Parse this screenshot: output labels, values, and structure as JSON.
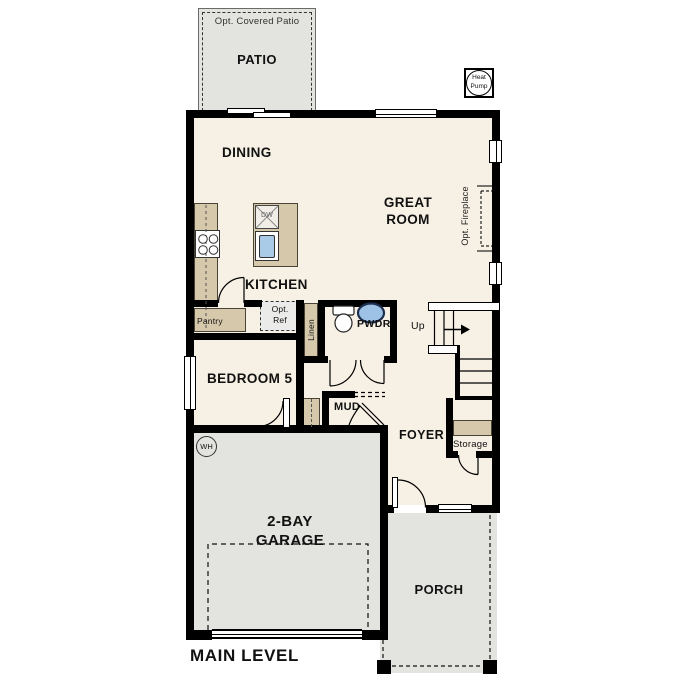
{
  "plan": {
    "level_title": "MAIN LEVEL",
    "labels": {
      "opt_covered_patio": "Opt. Covered Patio",
      "patio": "PATIO",
      "heat_pump": "Heat Pump",
      "dining": "DINING",
      "great_room": "GREAT ROOM",
      "opt_fireplace": "Opt. Fireplace",
      "kitchen": "KITCHEN",
      "dw": "DW",
      "pantry": "Pantry",
      "opt_ref": "Opt. Ref",
      "linen": "Linen",
      "pwdr": "PWDR",
      "up": "Up",
      "bedroom5": "BEDROOM 5",
      "mud": "MUD",
      "foyer": "FOYER",
      "storage": "Storage",
      "wh": "WH",
      "garage": "2-BAY GARAGE",
      "porch": "PORCH",
      "main_level": "MAIN LEVEL"
    },
    "colors": {
      "wall": "#000000",
      "floor": "#f7f0e4",
      "concrete": "#e3e3e0",
      "cabinet": "#d5c8ab",
      "sink_blue": "#a9cbe8",
      "fixture_blue": "#9ec2e6"
    }
  }
}
